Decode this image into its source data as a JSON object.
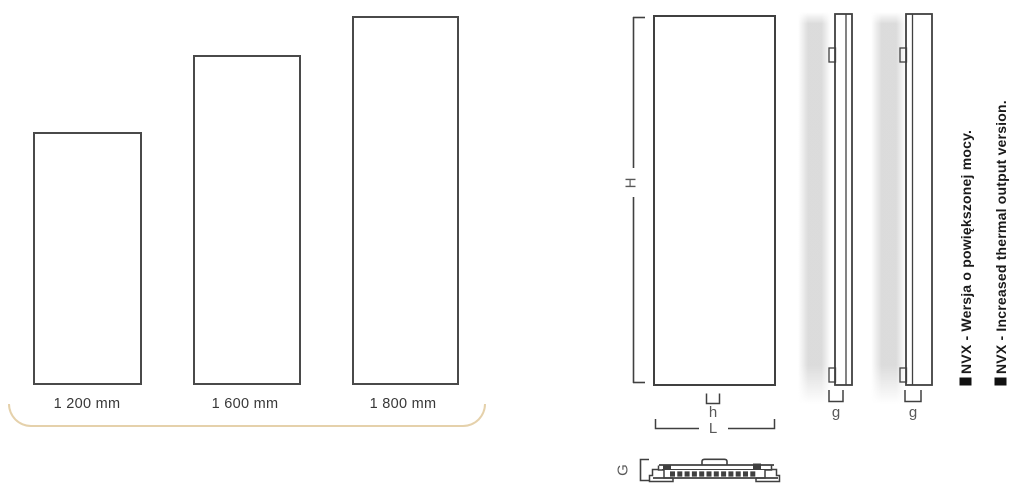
{
  "figure": {
    "left_chart": {
      "bars": [
        {
          "label": "1 200 mm",
          "height_mm": 1200
        },
        {
          "label": "1 600 mm",
          "height_mm": 1600
        },
        {
          "label": "1 800 mm",
          "height_mm": 1800
        }
      ],
      "underline_color": "#e5d1ab"
    },
    "drawing": {
      "dim_height": "H",
      "dim_connection": "h",
      "dim_length": "L",
      "dim_depth_standard": "g",
      "dim_depth_nvx": "g",
      "dim_section": "G",
      "annotation_pl": "NVX - Wersja o powiększonej mocy.",
      "annotation_en": "NVX - Increased thermal output version.",
      "line_color": "#404040",
      "label_color": "#595959",
      "shadow_color": "#d8d8d8"
    }
  }
}
